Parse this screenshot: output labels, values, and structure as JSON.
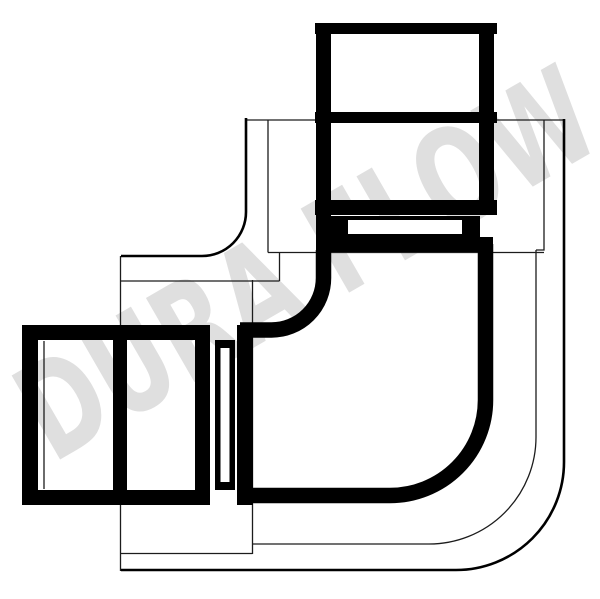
{
  "watermark": {
    "text": "DURA FLOW",
    "color": "#dfdfdf"
  },
  "drawing": {
    "colors": {
      "background": "#ffffff",
      "heavy_line": "#000000",
      "medium_line": "#000000",
      "thin_line": "#1c1c1c"
    }
  }
}
